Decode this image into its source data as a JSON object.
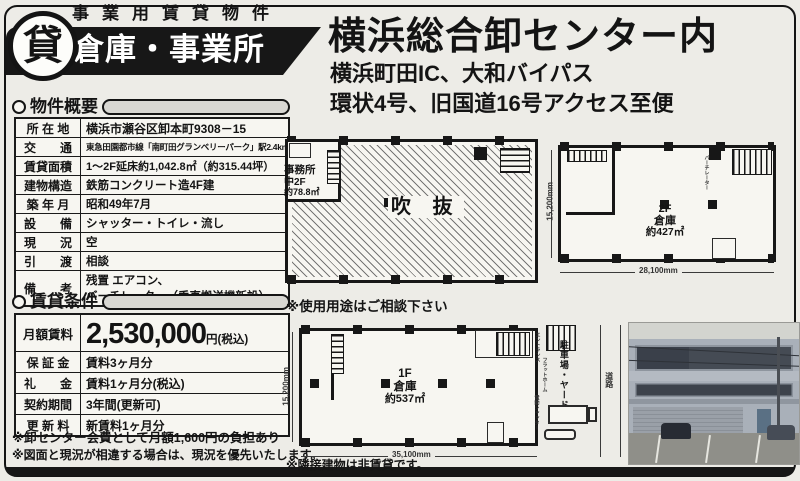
{
  "corner": {
    "clipped_text": "管理番号 42230001"
  },
  "badge": {
    "top_label": "事業用賃貸物件",
    "band_label": "倉庫・事業所",
    "circle_kanji": "貸"
  },
  "header": {
    "title": "横浜総合卸センター内",
    "subtitle1": "横浜町田IC、大和バイパス",
    "subtitle2": "環状4号、旧国道16号アクセス至便"
  },
  "overview": {
    "section_label": "物件概要",
    "rows": [
      {
        "label": "所 在 地",
        "value": "横浜市瀬谷区卸本町9308－15"
      },
      {
        "label": "交　　通",
        "value": "東急田園都市線「南町田グランベリーパーク」駅2.4km"
      },
      {
        "label": "賃貸面積",
        "value": "1～2F延床約1,042.8㎡（約315.44坪）"
      },
      {
        "label": "建物構造",
        "value": "鉄筋コンクリート造4F建"
      },
      {
        "label": "築 年 月",
        "value": "昭和49年7月"
      },
      {
        "label": "設　　備",
        "value": "シャッター・トイレ・流し"
      },
      {
        "label": "現　　況",
        "value": "空"
      },
      {
        "label": "引　　渡",
        "value": "相談"
      },
      {
        "label": "備　　考",
        "value": "残置 エアコン、",
        "value2": "バーチレーター（垂直搬送機新設）"
      }
    ]
  },
  "terms": {
    "section_label": "賃貸条件",
    "rent": {
      "label": "月額賃料",
      "amount": "2,530,000",
      "suffix": "円(税込)"
    },
    "rows": [
      {
        "label": "保 証 金",
        "value": "賃料3ヶ月分"
      },
      {
        "label": "礼　　金",
        "value": "賃料1ヶ月分(税込)"
      },
      {
        "label": "契約期間",
        "value": "3年間(更新可)"
      },
      {
        "label": "更 新 料",
        "value": "新賃料1ヶ月分"
      }
    ],
    "note1": "※卸センター会費として月額1,600円の負担あり",
    "note2": "※図面と現況が相違する場合は、現況を優先いたします。"
  },
  "plans": {
    "usage_note": "※使用用途はご相談下さい",
    "adjacent_note": "※隣接建物は非賃貸です。",
    "mezzanine": {
      "office_line1": "事務所",
      "office_line2": "中2F",
      "office_line3": "約78.8㎡",
      "void_label": "吹 抜"
    },
    "floor2": {
      "line1": "2F",
      "line2": "倉庫",
      "line3": "約427㎡",
      "dim_left": "15,200mm",
      "dim_bottom": "28,100mm",
      "vent_label": "バーチレーター"
    },
    "floor1": {
      "line1": "1F",
      "line2": "倉庫",
      "line3": "約537㎡",
      "dim_left": "15,200mm",
      "dim_bottom": "35,100mm",
      "parking_label": "駐車場・ヤード",
      "platform_label": "フラットホーム",
      "shutter_label": "電動シャッター",
      "road_label": "道路",
      "entrance_label": "エントランス"
    }
  }
}
